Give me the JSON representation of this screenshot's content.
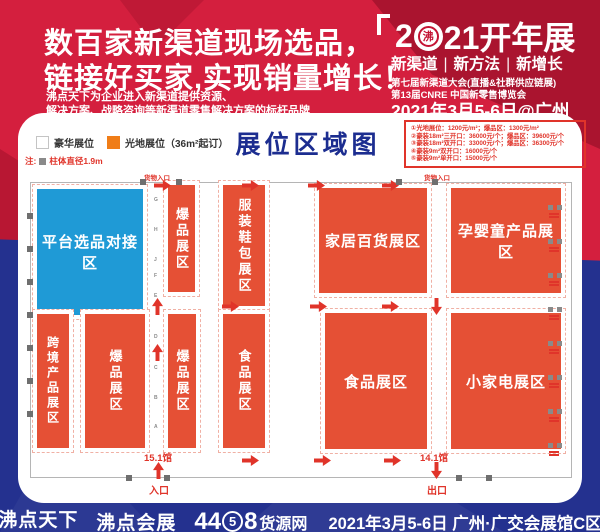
{
  "banner": {
    "headline1": "数百家新渠道现场选品，",
    "headline2": "链接好买家,实现销量增长！",
    "sub1": "沸点天下为企业进入新渠道提供资源、",
    "sub2": "解决方案、战略咨询等新渠道零售解决方案的标杆品牌",
    "event": {
      "num_left": "2",
      "zero_glyph": "沸",
      "num_right": "21开年展",
      "tags": [
        "新渠道",
        "新方法",
        "新增长"
      ],
      "separator": "|",
      "sub1": "第七届新渠道大会(直播&社群供应链展)",
      "sub2": "第13届CNRE 中国新零售博览会",
      "date": "2021年3月5-6日@广州"
    }
  },
  "panel": {
    "title": "展位区域图",
    "legend": {
      "luxury_label": "豪华展位",
      "open_label": "光地展位（36m²起订）",
      "note_prefix": "注:",
      "note_text": "柱体直径1.9m"
    },
    "prices": [
      "①光地展位：1200元/m²；爆品区：1300元/m²",
      "②豪装18m²三开口：36000元/个；爆品区：39600元/个",
      "③豪装18m²双开口：33000元/个；爆品区：36300元/个",
      "④豪装9m²双开口：16000元/个",
      "⑤豪装9m²单开口：15000元/个"
    ]
  },
  "map": {
    "zones": {
      "platform": {
        "label": "平台选品对接区"
      },
      "hot_top": {
        "label": "爆品展区"
      },
      "apparel": {
        "label": "服装鞋包展区"
      },
      "home": {
        "label": "家居百货展区"
      },
      "baby": {
        "label": "孕婴童产品展区"
      },
      "crossborder": {
        "label": "跨境产品展区"
      },
      "hot_b1": {
        "label": "爆品展区"
      },
      "hot_b2": {
        "label": "爆品展区"
      },
      "food_narrow": {
        "label": "食品展区"
      },
      "food_large": {
        "label": "食品展区"
      },
      "appliance": {
        "label": "小家电展区"
      }
    },
    "labels": {
      "cargo_entrance": "货物入口",
      "hall_left": "15.1馆",
      "hall_right": "14.1馆",
      "entrance": "入口",
      "exit": "出口"
    },
    "aisle_letters": [
      "G",
      "H",
      "J",
      "F",
      "E",
      "D",
      "C",
      "B",
      "A"
    ]
  },
  "footer": {
    "brand1": "沸点天下",
    "brand1_tagline": "99℃+1℃=100℃",
    "brand2": "沸点会展",
    "brand3_left": "44",
    "brand3_circled": "5",
    "brand3_right": "8",
    "brand3_name": "货源网",
    "date": "2021年3月5-6日 广州·广交会展馆C区"
  },
  "colors": {
    "banner_red": "#d41f3e",
    "navy": "#24318f",
    "booth_red": "#e55035",
    "platform_blue": "#1f9ad6",
    "legend_orange": "#f07d18",
    "accent_red": "#e0342a",
    "title_blue": "#1c2d90"
  }
}
